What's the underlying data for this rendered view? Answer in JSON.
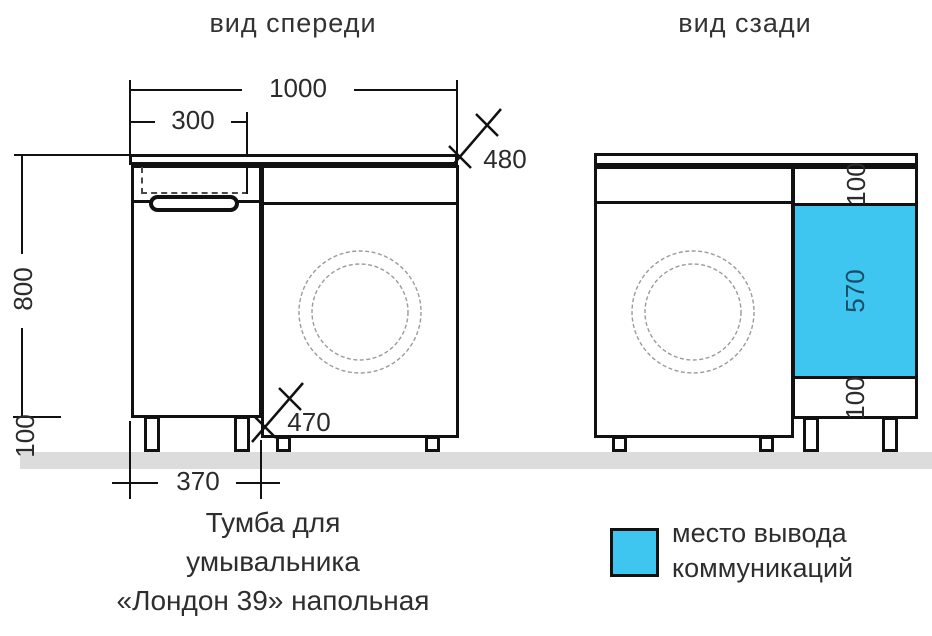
{
  "titles": {
    "front_view": "вид спереди",
    "back_view": "вид сзади"
  },
  "front": {
    "dim_total_width": "1000",
    "dim_sink_width": "300",
    "dim_counter_depth": "480",
    "dim_body_height": "800",
    "dim_leg_height": "100",
    "dim_cabinet_width": "370",
    "dim_niche_width": "470"
  },
  "back": {
    "dim_top_offset": "100",
    "dim_outlet_height": "570",
    "dim_bottom_offset": "100"
  },
  "legend": {
    "line1": "место вывода",
    "line2": "коммуникаций"
  },
  "caption": {
    "line1": "Тумба для",
    "line2": "умывальника",
    "line3": "«Лондон 39» напольная"
  },
  "colors": {
    "outlet_fill": "#3fc6f0",
    "outlet_text": "#1a4e66",
    "floor": "#dcdcdc",
    "line": "#111111",
    "circle": "#9b9b9b"
  }
}
